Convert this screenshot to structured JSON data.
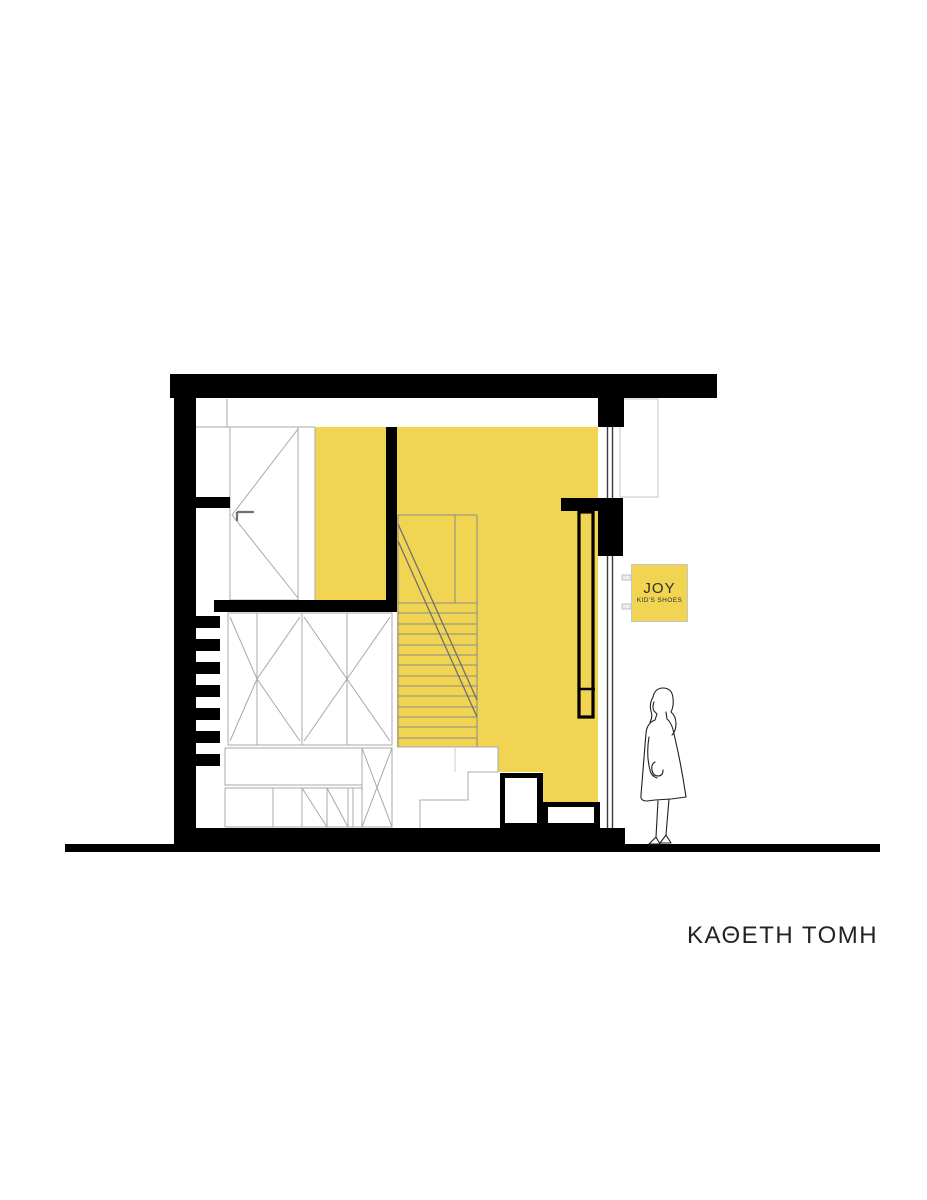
{
  "drawing": {
    "title": "ΚΑΘΕΤΗ ΤΟΜΗ",
    "sign": {
      "line1": "JOY",
      "line2": "KID'S SHOES"
    },
    "colors": {
      "accent_yellow": "#F0D452",
      "ink_black": "#000000",
      "line_gray": "#a8a8a8",
      "dark_line": "#3a3a3a",
      "sign_border": "#c6c6c6",
      "title_ink": "#232323"
    }
  }
}
